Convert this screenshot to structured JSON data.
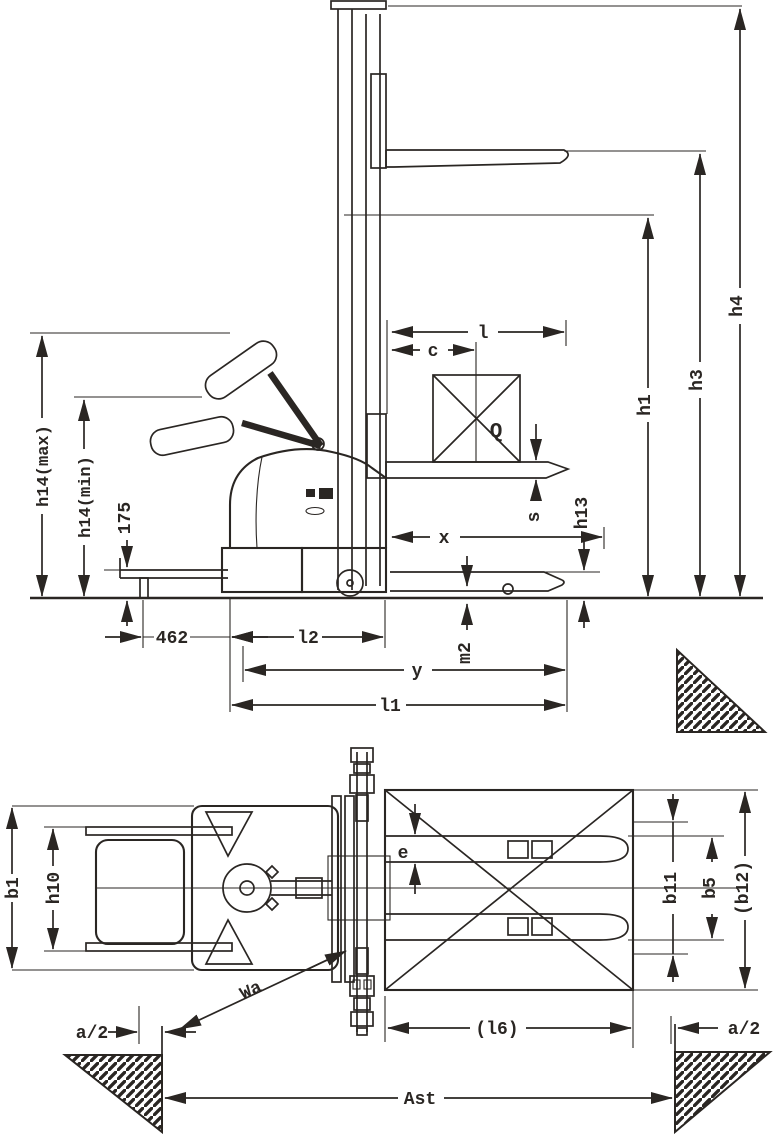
{
  "drawing": {
    "kind": "pallet-stacker dimensional line drawing, side elevation and plan view",
    "ink_color": "#2a2623",
    "paper_color": "#ffffff"
  },
  "side_view": {
    "labels": {
      "h14_max": "h14(max)",
      "h14_min": "h14(min)",
      "tiller_height": "175",
      "platform_length": "462",
      "l2": "l2",
      "wheelbase": "y",
      "l1": "l1",
      "m2": "m2",
      "load_distance": "x",
      "fork_thickness": "s",
      "h13": "h13",
      "load_center": "c",
      "fork_length": "l",
      "load": "Q",
      "h1": "h1",
      "h3": "h3",
      "h4": "h4"
    }
  },
  "top_view": {
    "labels": {
      "b1": "b1",
      "h10": "h10",
      "fork_width": "e",
      "b11": "b11",
      "b5": "b5",
      "b12": "(b12)",
      "l6": "(l6)",
      "clearance_left": "a/2",
      "clearance_right": "a/2",
      "aisle_width": "Ast",
      "turning_radius": "Wa"
    }
  }
}
